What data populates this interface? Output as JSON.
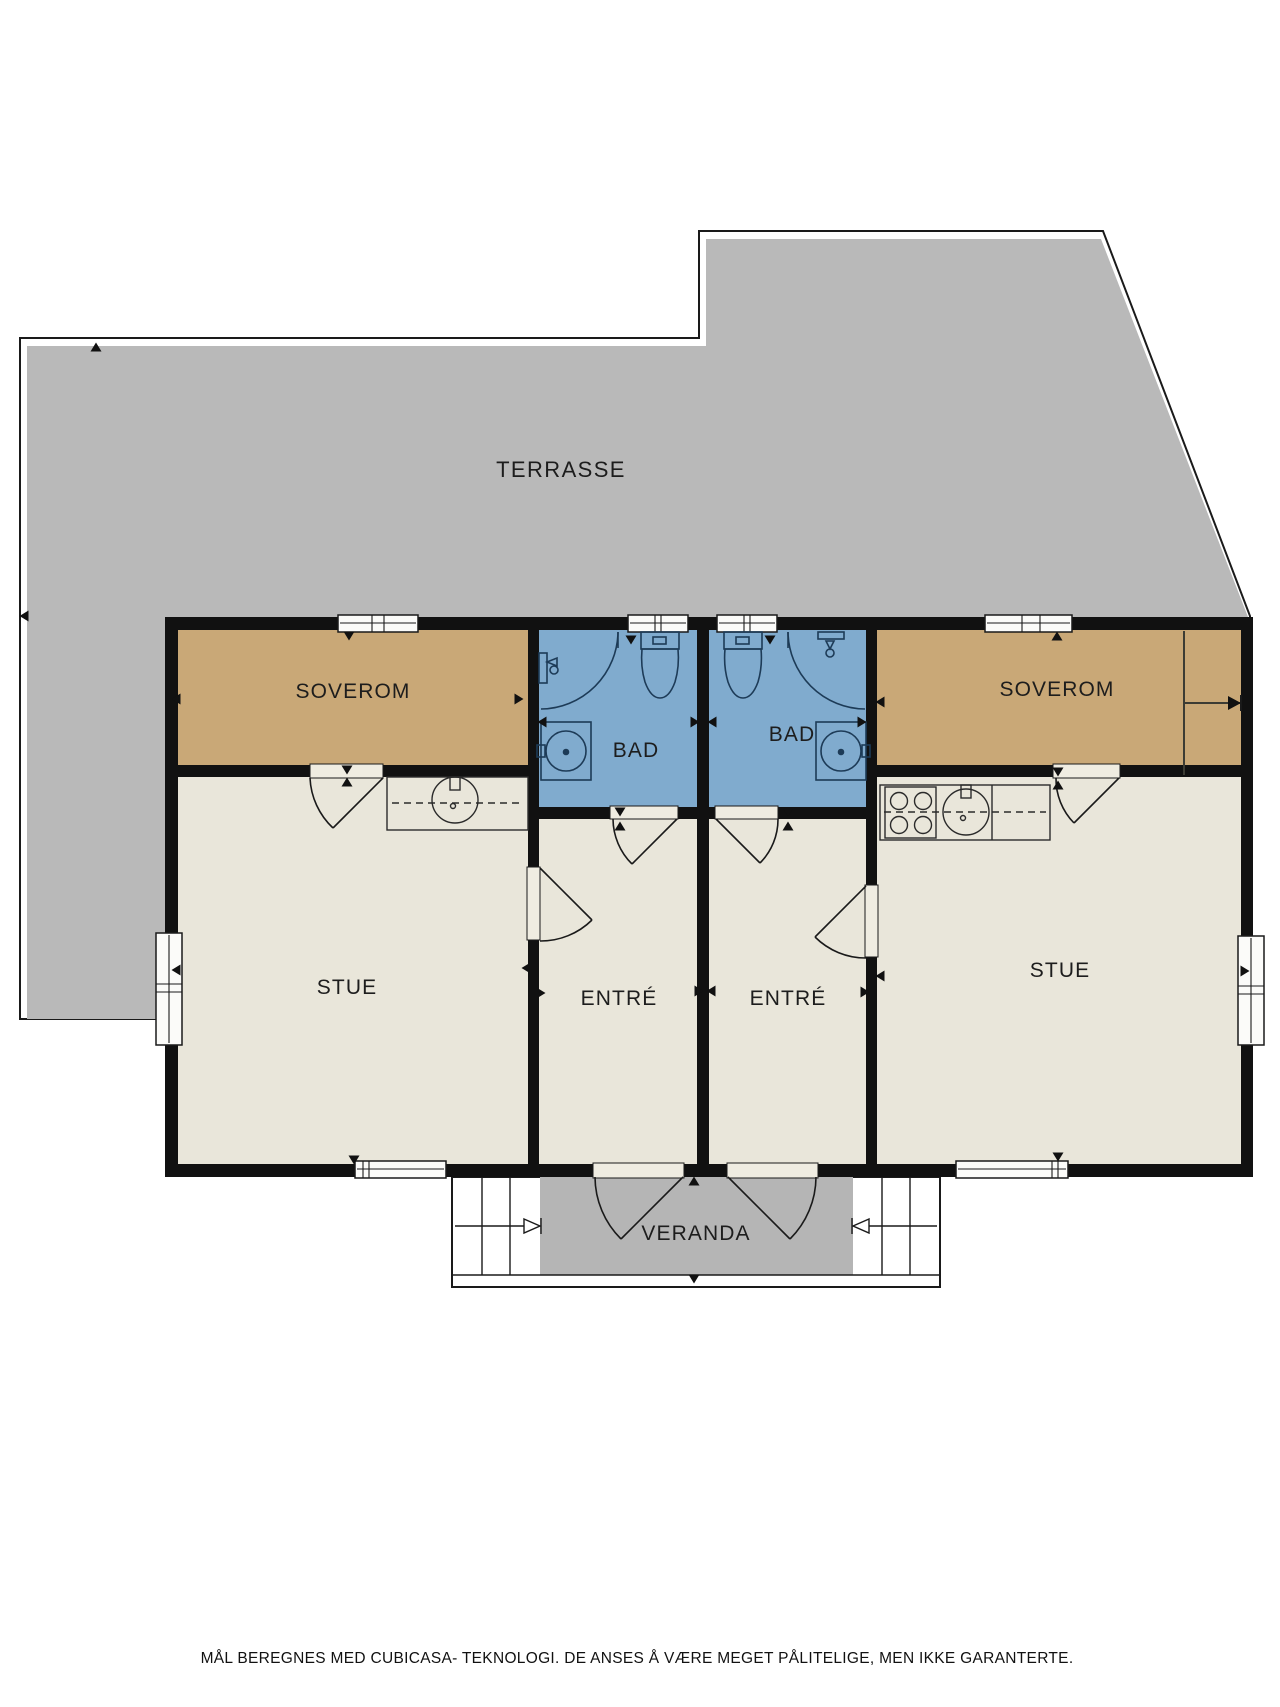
{
  "plan": {
    "rooms": [
      {
        "id": "terrace",
        "label": "TERRASSE",
        "type": "terrace"
      },
      {
        "id": "soverom-left",
        "label": "SOVEROM",
        "type": "bedroom"
      },
      {
        "id": "bad-left",
        "label": "BAD",
        "type": "bathroom"
      },
      {
        "id": "bad-right",
        "label": "BAD",
        "type": "bathroom"
      },
      {
        "id": "soverom-right",
        "label": "SOVEROM",
        "type": "bedroom"
      },
      {
        "id": "stue-left",
        "label": "STUE",
        "type": "living"
      },
      {
        "id": "entre-left",
        "label": "ENTRÉ",
        "type": "hall"
      },
      {
        "id": "entre-right",
        "label": "ENTRÉ",
        "type": "hall"
      },
      {
        "id": "stue-right",
        "label": "STUE",
        "type": "living"
      },
      {
        "id": "veranda",
        "label": "VERANDA",
        "type": "veranda"
      }
    ]
  },
  "colors": {
    "terrace": "#b9b9b9",
    "veranda": "#b5b5b5",
    "wall": "#111111",
    "bedroom": "#c9a877",
    "bathroom": "#80abce",
    "living": "#e9e6da",
    "door": "#efece1",
    "window": "#fbfbf9",
    "fixture": "#1d3b57"
  },
  "footer": {
    "disclaimer": "MÅL BEREGNES MED CUBICASA- TEKNOLOGI. DE ANSES Å VÆRE MEGET PÅLITELIGE, MEN IKKE GARANTERTE."
  }
}
